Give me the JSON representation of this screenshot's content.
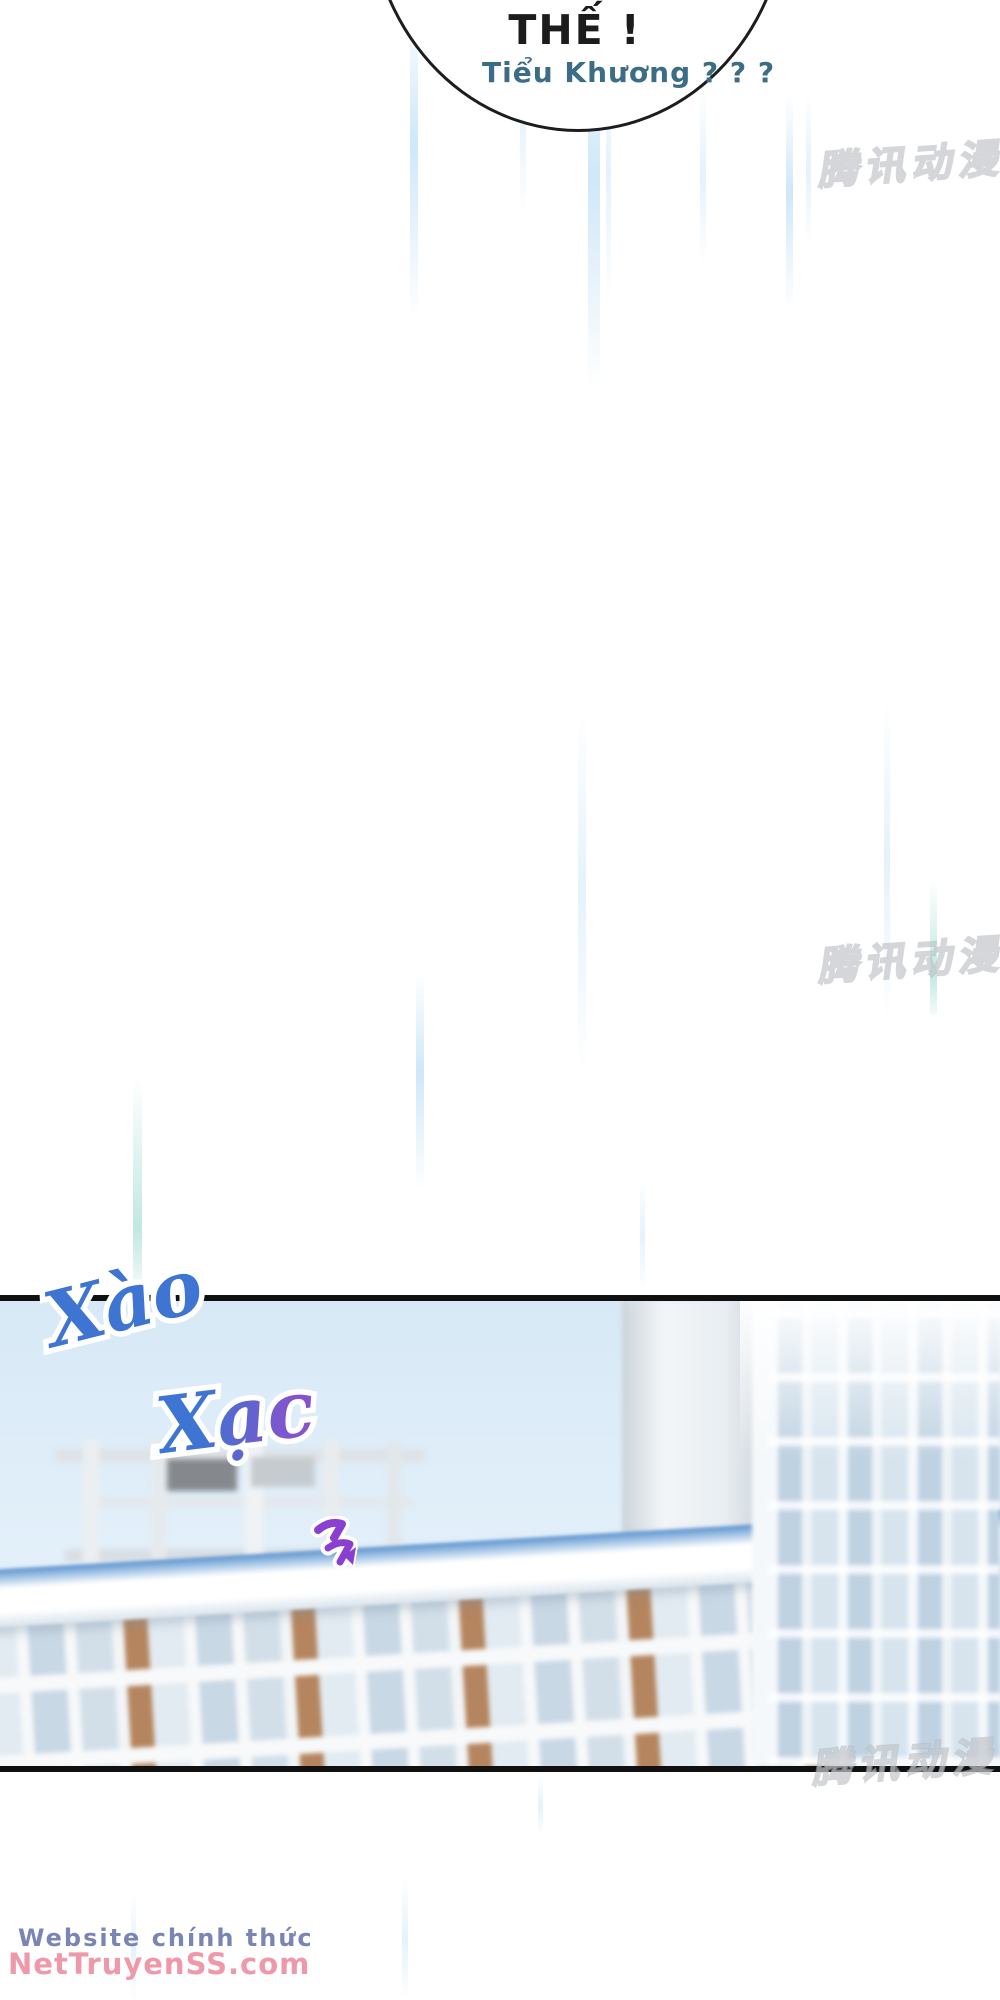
{
  "comic": {
    "bubble": {
      "line1": "THẾ !",
      "line2": "Tiểu Khương ?  ? ?"
    },
    "sfx": {
      "word1": "Xào",
      "word2": "Xạc"
    },
    "publisher_watermark": "腾讯动漫",
    "site_watermark": {
      "line1": "Website chính thức",
      "line2": "NetTruyenSS.com"
    },
    "colors": {
      "bubble_line1": "#1c1c1c",
      "bubble_line2": "#3c6d86",
      "sfx_blue": "#3e74d2",
      "sfx_purple": "#8653cc",
      "site_line1": "#7a85b4",
      "site_line2": "#ee98a9",
      "publisher_watermark": "#c3c8cd",
      "arrow": "#8a3fd0",
      "sky": "#d7e9f6",
      "brick": "#b5855f",
      "panel_border": "#101010"
    }
  }
}
